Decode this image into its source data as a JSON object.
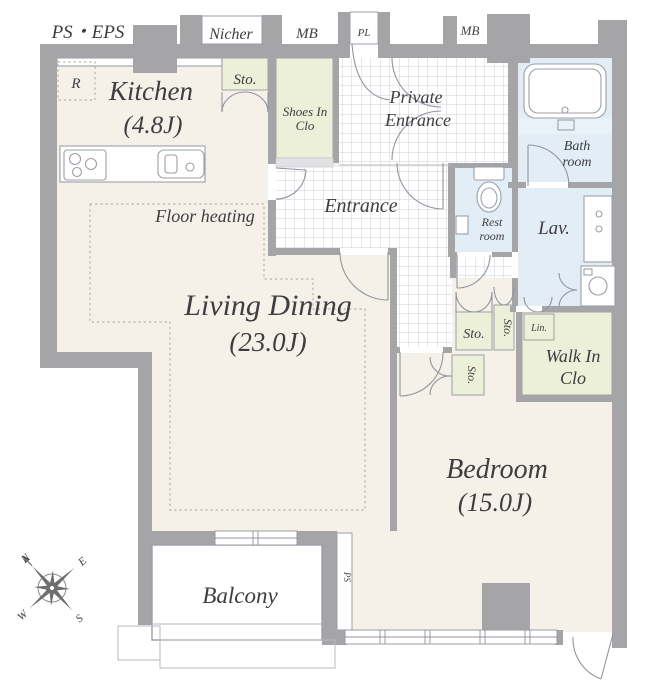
{
  "plan": {
    "exterior": {
      "ps_eps": "PS・EPS",
      "nicher": "Nicher",
      "mb_left": "MB",
      "pl": "PL",
      "mb_right": "MB"
    },
    "rooms": {
      "kitchen": {
        "name": "Kitchen",
        "size": "(4.8J)",
        "fridge": "R"
      },
      "sto_top": "Sto.",
      "shoes_clo": {
        "line1": "Shoes In",
        "line2": "Clo"
      },
      "private_entrance": {
        "line1": "Private",
        "line2": "Entrance"
      },
      "entrance": "Entrance",
      "bathroom": {
        "line1": "Bath",
        "line2": "room"
      },
      "restroom": {
        "line1": "Rest",
        "line2": "room"
      },
      "lavatory": "Lav.",
      "living_dining": {
        "name": "Living Dining",
        "size": "(23.0J)",
        "floor_heating": "Floor heating"
      },
      "sto_a": "Sto.",
      "sto_b": "Sto.",
      "sto_c": "Sto.",
      "linen": "Lin.",
      "walk_in_clo": {
        "line1": "Walk In",
        "line2": "Clo"
      },
      "bedroom": {
        "name": "Bedroom",
        "size": "(15.0J)"
      },
      "balcony": "Balcony",
      "ps_shaft": "PS"
    },
    "compass": {
      "n": "N",
      "e": "E",
      "s": "S",
      "w": "W"
    },
    "colors": {
      "wall": "#a5a5a7",
      "room_floor": "#f6f1e8",
      "closet": "#edf0d9",
      "wet_area": "#e3edf6",
      "tile_line": "#ccd1da",
      "text": "#3e3d40"
    }
  }
}
